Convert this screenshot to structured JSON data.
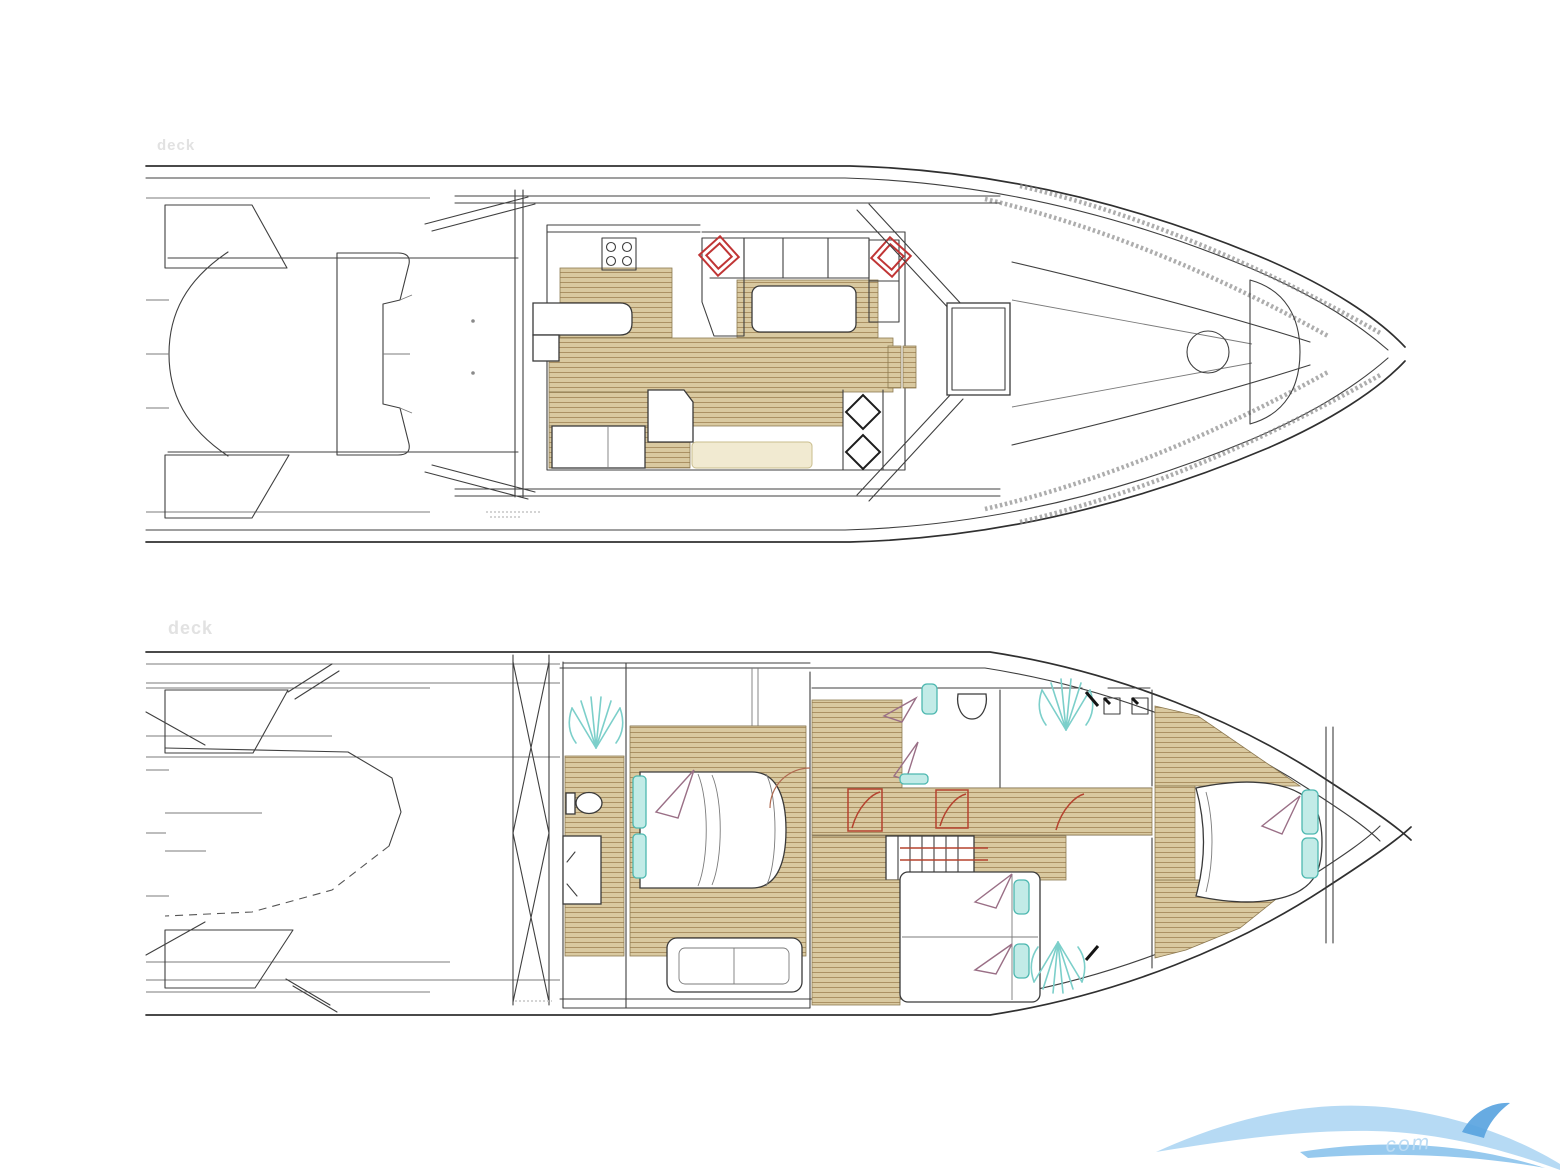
{
  "page": {
    "width": 1560,
    "height": 1170,
    "background": "#ffffff"
  },
  "plans": {
    "top": {
      "label": "deck"
    },
    "bottom": {
      "label": "deck"
    }
  },
  "watermark": {
    "text": "com"
  },
  "colors": {
    "line": "#3f3f3f",
    "wood_fill": "#d9c9a0",
    "wood_stripe": "#ab9164",
    "red_accent": "#c03535",
    "door_red": "#b5432f",
    "door_brown": "#b06a50",
    "teal_spray": "#7ccfca",
    "cyan_fixture": "#c2ebe7",
    "purple_decor": "#9a6f86",
    "pale_cushion": "#f1ead1",
    "logo_light_blue": "#a9d4f2",
    "logo_mid_blue": "#7cbcea",
    "logo_dark_blue": "#56a2df",
    "label_gray": "#e2e2e2"
  }
}
